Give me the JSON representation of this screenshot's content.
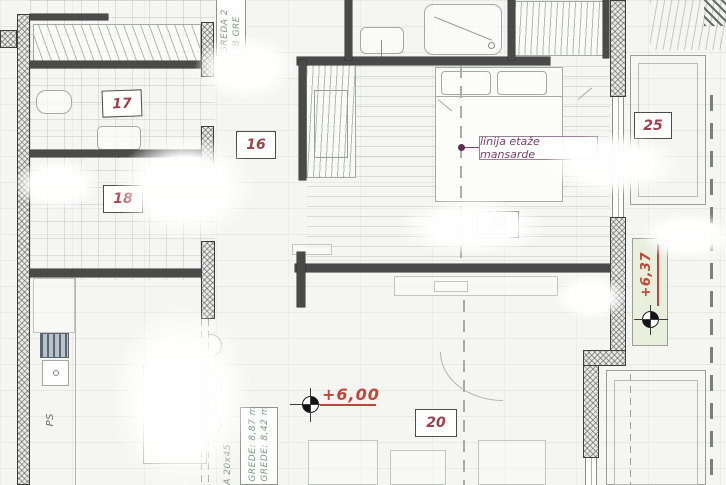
{
  "rooms": {
    "r17": {
      "number": "17"
    },
    "r16": {
      "number": "16"
    },
    "r18": {
      "number": "18"
    },
    "r24": {
      "number": "24"
    },
    "r25": {
      "number": "25"
    },
    "r20": {
      "number": "20"
    }
  },
  "annotations": {
    "mansarde_label": "linija etaže mansarde",
    "level_interior": "+6,00",
    "level_terrace": "+6,37",
    "beam_top_line1": "GREDA 2",
    "beam_top_line2": "AB GRE",
    "beam_bottom_outside": "A 20x45",
    "beam_bottom_line1": "GREDE: 8,87 m",
    "beam_bottom_line2": "GREDE: 8,42 m",
    "kitchen_ps": "PS"
  },
  "colors": {
    "wall": "#4a4a4a",
    "room_number": "#a03f48",
    "level_red": "#c2453a",
    "beam_green": "#7d9b80",
    "mansarde_purple": "#7b3f6e",
    "terrace_strip": "#e9efdd"
  }
}
